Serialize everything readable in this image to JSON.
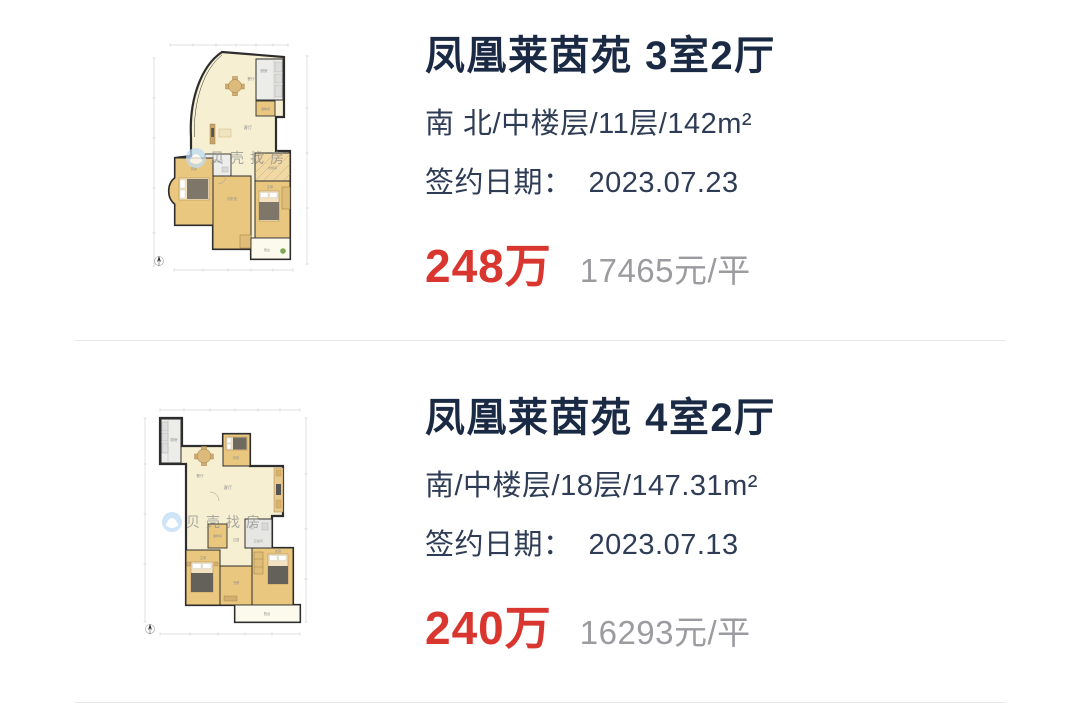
{
  "page": {
    "background": "#ffffff",
    "divider_color": "#e8e8e8"
  },
  "theme": {
    "title_color": "#1b2a44",
    "text_color": "#2f3c56",
    "price_color": "#d9362f",
    "unit_price_color": "#9b9ba0",
    "watermark_blue": "#bfdcf4"
  },
  "listings": [
    {
      "title": "凤凰莱茵苑 3室2厅",
      "info": "南 北/中楼层/11层/142m²",
      "sign_date_label": "签约日期：",
      "sign_date": "2023.07.23",
      "price": "248万",
      "unit_price": "17465元/平",
      "floorplan": {
        "watermark": "贝壳找房",
        "labels": {
          "kitchen": "厨房",
          "dining": "餐厅",
          "living": "客厅",
          "storage": "储物间",
          "bath": "卫生间",
          "bedroom_left": "次卧",
          "bedroom_mid": "次卧室",
          "cloak": "衣帽间",
          "master": "主卧",
          "balcony": "阳台"
        }
      }
    },
    {
      "title": "凤凰莱茵苑 4室2厅",
      "info": "南/中楼层/18层/147.31m²",
      "sign_date_label": "签约日期：",
      "sign_date": "2023.07.13",
      "price": "240万",
      "unit_price": "16293元/平",
      "floorplan": {
        "watermark": "贝壳找房",
        "labels": {
          "kitchen": "厨房",
          "dining": "餐厅",
          "living": "客厅",
          "storage": "储物间",
          "bath": "卫生间",
          "hall": "过道",
          "bedroom_top": "次卧",
          "master": "主卧",
          "study": "书房",
          "bedroom_right": "次卧",
          "balcony": "阳台"
        }
      }
    }
  ]
}
